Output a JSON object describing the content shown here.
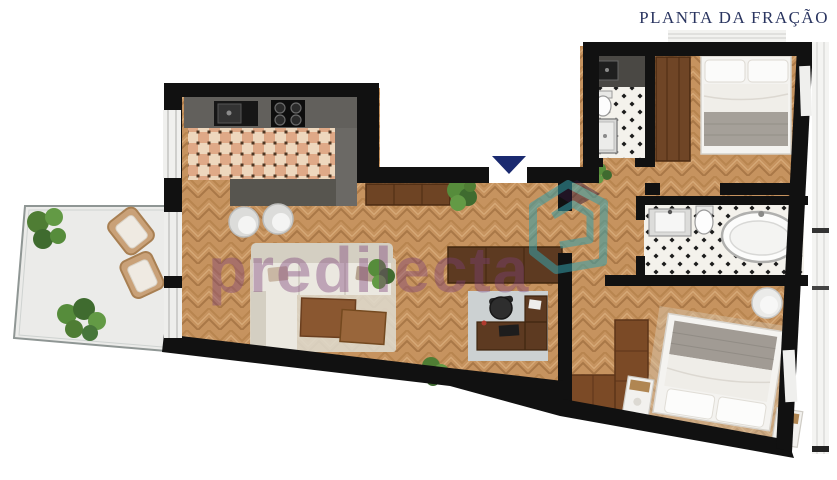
{
  "header": {
    "title": "PLANTA DA FRAÇÃO"
  },
  "watermark": {
    "text": "predilecta",
    "logo": "house-outline-icon"
  },
  "floorplan": {
    "entrance_marker": "down-triangle",
    "rooms": [
      "kitchen",
      "living-room",
      "home-office",
      "hallway",
      "terrace",
      "bedroom-1",
      "bedroom-2",
      "bathroom-main",
      "bathroom-wc"
    ]
  },
  "colors": {
    "title": "#2a3560",
    "wall": "#111111",
    "wood_floor": "#c6935f",
    "terrace_floor": "#ebebe9",
    "kitchen_tile": "#dfa987",
    "bath_tile": "#f4f2ec",
    "watermark_purple": "#7d3f78",
    "watermark_teal": "#35a0ab",
    "entrance_arrow": "#1a2a70"
  }
}
